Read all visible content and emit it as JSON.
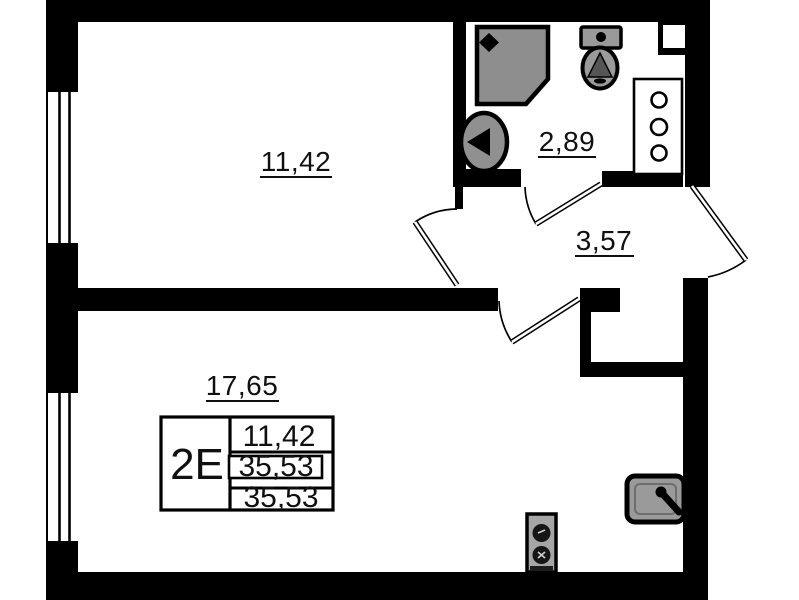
{
  "rooms": [
    {
      "id": "room-upper",
      "area": "11,42"
    },
    {
      "id": "bathroom",
      "area": "2,89"
    },
    {
      "id": "hallway",
      "area": "3,57"
    },
    {
      "id": "room-lower",
      "area": "17,65"
    }
  ],
  "stamp": {
    "unit_label": "2Е",
    "rows": [
      "11,42",
      "35,53",
      "35,53"
    ]
  },
  "colors": {
    "wall": "#000000",
    "floor": "#ffffff",
    "fixture_gray": "#8e8e8e",
    "fixture_light_gray": "#a6a6a6"
  },
  "icons": {
    "shower": "shower-icon",
    "washbasin": "washbasin-icon",
    "toilet": "toilet-icon",
    "utility_shaft": "utility-shaft-icon",
    "kitchen_sink": "kitchen-sink-icon",
    "stove": "stove-icon",
    "window": "window-glazing",
    "door": "door-swing"
  }
}
